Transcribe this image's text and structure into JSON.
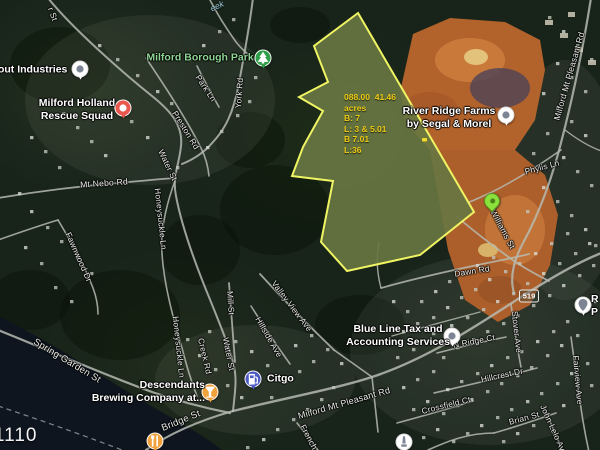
{
  "map": {
    "corner_text": "1110",
    "creek_label": {
      "text": "eek"
    },
    "route_shield": {
      "number": "519"
    },
    "parcel": {
      "annotation_lines": [
        "088.00  41.46",
        "acres",
        "B: 7",
        "L: 3 & 5.01",
        "B 7.01",
        "L:36"
      ],
      "annotation_color": "#eecb15",
      "fill": "rgba(228,240,140,0.22)",
      "meadow_fill": "#41502a",
      "outline_color": "#eff463"
    },
    "poi_labels": [
      {
        "name": "industries-label",
        "lines": [
          "atout Industries"
        ],
        "x": 28,
        "y": 70
      },
      {
        "name": "rescue-squad-label",
        "lines": [
          "Milford Holland",
          "Rescue Squad"
        ],
        "x": 77,
        "y": 110
      },
      {
        "name": "borough-park-label",
        "lines": [
          "Milford Borough Park"
        ],
        "x": 200,
        "y": 58,
        "kind": "park"
      },
      {
        "name": "river-ridge-label",
        "lines": [
          "River Ridge Farms",
          "by Segal & Morel"
        ],
        "x": 449,
        "y": 118
      },
      {
        "name": "blue-line-tax-label",
        "lines": [
          "Blue Line Tax and",
          "Accounting Services"
        ],
        "x": 398,
        "y": 336
      },
      {
        "name": "descendants-label",
        "lines": [
          "Descendants",
          "Brewing Company at..."
        ],
        "x": 205,
        "y": 392,
        "align": "right"
      },
      {
        "name": "citgo-label",
        "lines": [
          "Citgo"
        ],
        "x": 267,
        "y": 379,
        "align": "left"
      },
      {
        "name": "edge-poi-label",
        "lines": [
          "R",
          "P"
        ],
        "x": 591,
        "y": 306,
        "align": "left"
      }
    ],
    "road_labels": [
      {
        "text": "r St",
        "x": 53,
        "y": 14,
        "rot": 70
      },
      {
        "text": "York Rd",
        "x": 239,
        "y": 93,
        "rot": -86
      },
      {
        "text": "Park Ln",
        "x": 206,
        "y": 88,
        "rot": 56
      },
      {
        "text": "Preston Rd",
        "x": 186,
        "y": 130,
        "rot": 58
      },
      {
        "text": "Water St",
        "x": 168,
        "y": 165,
        "rot": 64
      },
      {
        "text": "Mt Nebo Rd",
        "x": 104,
        "y": 183,
        "rot": -4,
        "size": 8.6
      },
      {
        "text": "Honeysuckle Ln",
        "x": 161,
        "y": 219,
        "rot": 84
      },
      {
        "text": "Fawnwood Dr",
        "x": 79,
        "y": 257,
        "rot": 66
      },
      {
        "text": "Spring Garden St",
        "x": 67,
        "y": 361,
        "rot": 31,
        "size": 9.5
      },
      {
        "text": "Honeysuckle Ln",
        "x": 179,
        "y": 347,
        "rot": 84
      },
      {
        "text": "Creek Rd",
        "x": 205,
        "y": 356,
        "rot": 77
      },
      {
        "text": "Mill St",
        "x": 231,
        "y": 303,
        "rot": 86
      },
      {
        "text": "Water St",
        "x": 229,
        "y": 354,
        "rot": 79
      },
      {
        "text": "Hillside Ave",
        "x": 269,
        "y": 337,
        "rot": 60
      },
      {
        "text": "Valley View Ave",
        "x": 292,
        "y": 306,
        "rot": 53
      },
      {
        "text": "Bridge St",
        "x": 181,
        "y": 421,
        "rot": -22,
        "size": 9.5
      },
      {
        "text": "Milford Mt Pleasant Rd",
        "x": 344,
        "y": 403,
        "rot": -16,
        "size": 9
      },
      {
        "text": "French",
        "x": 309,
        "y": 437,
        "rot": 62
      },
      {
        "text": "Dawn Rd",
        "x": 472,
        "y": 271,
        "rot": -9
      },
      {
        "text": "N Ridge Ct",
        "x": 474,
        "y": 341,
        "rot": -11
      },
      {
        "text": "Stover Ave",
        "x": 517,
        "y": 332,
        "rot": 84
      },
      {
        "text": "Hillcrest Dr",
        "x": 502,
        "y": 375,
        "rot": -12
      },
      {
        "text": "Crossfield Ct",
        "x": 446,
        "y": 405,
        "rot": -14
      },
      {
        "text": "Brian St",
        "x": 524,
        "y": 418,
        "rot": -15
      },
      {
        "text": "John Lelo Ave",
        "x": 554,
        "y": 430,
        "rot": 66
      },
      {
        "text": "Fairview Ave",
        "x": 578,
        "y": 380,
        "rot": 85
      },
      {
        "text": "Williams St",
        "x": 503,
        "y": 229,
        "rot": 62
      },
      {
        "text": "Phylis Ln",
        "x": 542,
        "y": 167,
        "rot": -15
      },
      {
        "text": "Milford Mt Pleasant Rd",
        "x": 569,
        "y": 76,
        "rot": -74,
        "size": 8.6
      }
    ],
    "markers": [
      {
        "name": "industries-marker",
        "icon": "dot-icon",
        "style": "white",
        "x": 80,
        "y": 69
      },
      {
        "name": "rescue-squad-marker",
        "icon": "dot-icon",
        "style": "red",
        "x": 123,
        "y": 108
      },
      {
        "name": "borough-park-marker",
        "icon": "tree-icon",
        "style": "green",
        "x": 263,
        "y": 58
      },
      {
        "name": "river-ridge-marker",
        "icon": "dot-icon",
        "style": "white",
        "x": 506,
        "y": 115
      },
      {
        "name": "parcel-pin",
        "icon": "pin-icon",
        "style": "lime-pin",
        "x": 492,
        "y": 209
      },
      {
        "name": "blue-line-tax-marker",
        "icon": "dot-icon",
        "style": "white",
        "x": 452,
        "y": 336
      },
      {
        "name": "descendants-marker",
        "icon": "martini-icon",
        "style": "orange",
        "x": 210,
        "y": 392
      },
      {
        "name": "citgo-marker",
        "icon": "fuel-icon",
        "style": "blue",
        "x": 253,
        "y": 379
      },
      {
        "name": "restaurant-marker",
        "icon": "restaurant-icon",
        "style": "orange",
        "x": 155,
        "y": 441
      },
      {
        "name": "monument-marker",
        "icon": "monument-icon",
        "style": "white",
        "x": 404,
        "y": 442
      },
      {
        "name": "edge-poi-marker",
        "icon": "pin-icon",
        "style": "white",
        "x": 583,
        "y": 305
      }
    ],
    "marker_styles": {
      "white": {
        "bg": "#ffffff",
        "fg": "#7d8594"
      },
      "red": {
        "bg": "#e9574f",
        "fg": "#ffffff"
      },
      "green": {
        "bg": "#2f9e49",
        "fg": "#ffffff"
      },
      "orange": {
        "bg": "#f2a23d",
        "fg": "#ffffff"
      },
      "blue": {
        "bg": "#4f5bc4",
        "fg": "#ffffff"
      },
      "lime-pin": {
        "bg": "#8ce03c",
        "fg": "#45821a"
      }
    },
    "colors": {
      "water": "#0e151f",
      "road": "#b6bab1",
      "dirt": "#b2632c",
      "forest_base": "#18231a"
    }
  }
}
